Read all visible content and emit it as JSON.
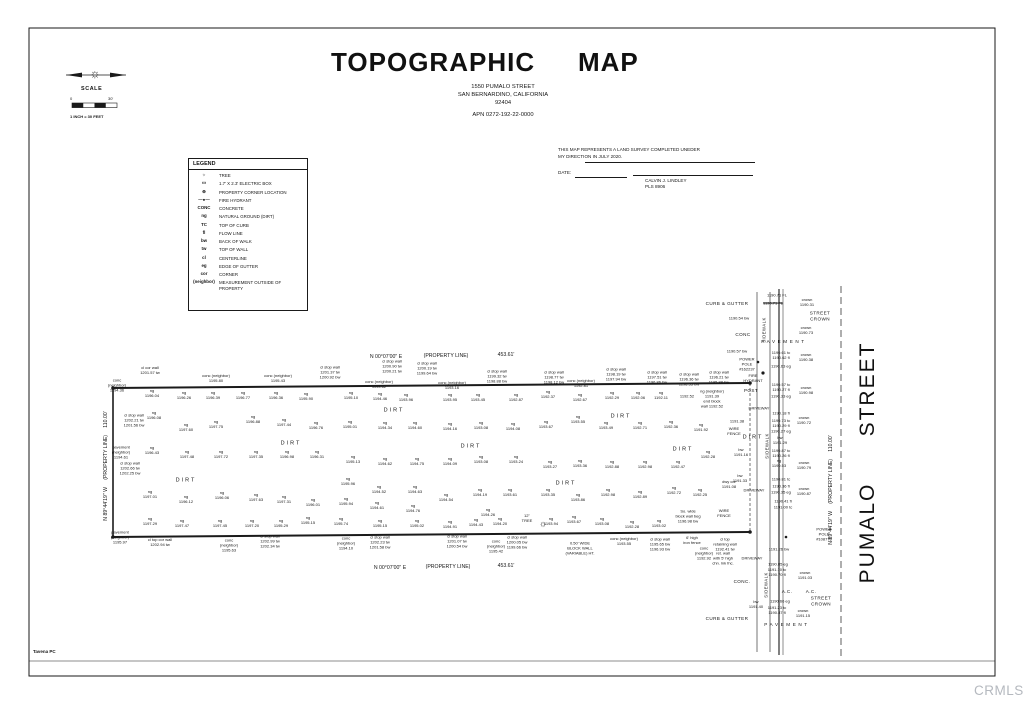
{
  "meta": {
    "watermark": "CRMLS",
    "credit": "Tavena PC"
  },
  "header": {
    "title_word1": "TOPOGRAPHIC",
    "title_word2": "MAP",
    "address_line1": "1550  PUMALO STREET",
    "address_line2": "SAN BERNARDINO, CALIFORNIA",
    "address_line3": "92404",
    "apn": "APN  0272-192-22-0000"
  },
  "scale": {
    "label": "SCALE",
    "start": "0",
    "end": "30'",
    "note": "1 INCH = 30 FEET"
  },
  "legend": {
    "title": "LEGEND",
    "items": [
      {
        "s": "☼",
        "d": "TREE"
      },
      {
        "s": "▭",
        "d": "1.7' X 2.3' ELECTRIC BOX"
      },
      {
        "s": "⊕",
        "d": "PROPERTY CORNER LOCATION"
      },
      {
        "s": "—●—",
        "d": "FIRE HYDRANT"
      },
      {
        "s": "CONC",
        "d": "CONCRETE"
      },
      {
        "s": "ng",
        "d": "NATURAL GROUND (DIRT)"
      },
      {
        "s": "TC",
        "d": "TOP OF CURB"
      },
      {
        "s": "fl",
        "d": "FLOW LINE"
      },
      {
        "s": "bw",
        "d": "BACK OF WALK"
      },
      {
        "s": "tw",
        "d": "TOP OF WALL"
      },
      {
        "s": "cl",
        "d": "CENTERLINE"
      },
      {
        "s": "eg",
        "d": "EDGE OF GUTTER"
      },
      {
        "s": "cor",
        "d": "CORNER"
      },
      {
        "s": "(neighbor)",
        "d": "MEASUREMENT OUTSIDE OF PROPERTY"
      }
    ]
  },
  "certification": {
    "line1": "THIS MAP REPRESENTS A LAND SURVEY COMPLETED UNEDER",
    "line2": "MY DIRECTION IN JULY 2020.",
    "date_label": "DATE:",
    "surveyor": "CALVIN J. LINDLEY",
    "license": "PLS 8906"
  },
  "map": {
    "street_name": "PUMALO STREET",
    "annotations": [
      [
        386,
        357,
        "N 00°07'00\" E",
        "br"
      ],
      [
        446,
        356,
        "(PROPERTY LINE)",
        "br"
      ],
      [
        506,
        355,
        "453.61'",
        "br"
      ],
      [
        390,
        568,
        "N 00°07'00\" E",
        "br"
      ],
      [
        448,
        567,
        "(PROPERTY LINE)",
        "br"
      ],
      [
        506,
        566,
        "453.61'",
        "br"
      ],
      [
        106,
        466,
        "N 89°44'19\" W     (PROPERTY LINE)     110.00'",
        "br",
        -90
      ],
      [
        831,
        490,
        "N 89°44'19\" W     (PROPERTY LINE)     110.00'",
        "br",
        -90
      ],
      [
        868,
        389,
        "STREET",
        "bigst",
        -90,
        "street-name"
      ],
      [
        868,
        533,
        "PUMALO",
        "bigst",
        -90,
        "street-name"
      ],
      [
        95,
        74,
        "☼",
        "compass-star",
        0,
        "compass-star-icon"
      ],
      [
        543,
        524,
        "☼",
        "tree",
        0,
        "tree-icon"
      ],
      [
        150,
        371,
        "cl cor wall\n1201.57 tw",
        "wl"
      ],
      [
        216,
        379,
        "conc (neighbor)\n1195.80",
        "wl"
      ],
      [
        278,
        379,
        "conc (neighbor)\n1195.43",
        "wl"
      ],
      [
        330,
        373,
        "cl stop wall\n1201.37 tw\n1200.92 bw",
        "wl"
      ],
      [
        392,
        367,
        "cl stop wall\n1200.90 tw\n1200.21 tw",
        "wl"
      ],
      [
        427,
        369,
        "cl stop wall\n1200.19 tw\n1199.64 bw",
        "wl"
      ],
      [
        379,
        385,
        "conc (neighbor)\n1193.62",
        "wl"
      ],
      [
        452,
        386,
        "conc (neighbor)\n1193.16",
        "wl"
      ],
      [
        497,
        377,
        "cl stop wall\n1199.32 tw\n1198.88 bw",
        "wl"
      ],
      [
        554,
        378,
        "cl stop wall\n1198.77 tw\n1198.12 bw",
        "wl"
      ],
      [
        581,
        384,
        "conc (neighbor)\n1192.81",
        "wl"
      ],
      [
        616,
        375,
        "cl stop wall\n1198.19 tw\n1197.94 bw",
        "wl"
      ],
      [
        657,
        378,
        "cl stop wall\n1197.51 tw\n1196.86 bw",
        "wl"
      ],
      [
        689,
        380,
        "cl stop wall\n1196.36 tw\n1196.33 bw",
        "wl"
      ],
      [
        719,
        378,
        "cl stop wall\n1196.21 tw\n1195.88 bw",
        "wl"
      ],
      [
        117,
        386,
        "conc\n(neighbor)\n1194.36",
        "wl"
      ],
      [
        134,
        421,
        "cl stop wall\n1202.21 tw\n1201.56 bw",
        "wl"
      ],
      [
        121,
        453,
        "pavement\n(neighbor)\n1194.61",
        "wl"
      ],
      [
        130,
        469,
        "cl stop wall\n1202.66 tw\n1202.25 bw",
        "wl"
      ],
      [
        120,
        538,
        "pavement\n(neighbor)\n1195.97",
        "wl"
      ],
      [
        160,
        543,
        "cl top cor wall\n1202.94 tw",
        "wl"
      ],
      [
        229,
        546,
        "conc\n(neighbor)\n1195.63",
        "wl"
      ],
      [
        270,
        542,
        "cl stop wall\n1202.99 tw\n1202.34 tw",
        "wl"
      ],
      [
        346,
        544,
        "conc\n(neighbor)\n1194.10",
        "wl"
      ],
      [
        380,
        543,
        "cl stop wall\n1202.23 tw\n1201.58 bw",
        "wl"
      ],
      [
        457,
        542,
        "cl stop wall\n1201.07 tw\n1200.54 bw",
        "wl"
      ],
      [
        496,
        547,
        "conc\n(neighbor)\n1195.42",
        "wl"
      ],
      [
        517,
        543,
        "cl stop wall\n1200.05 bw\n1199.66 bw",
        "wl"
      ],
      [
        527,
        519,
        "12\"\nTREE",
        "wl"
      ],
      [
        580,
        549,
        "0.50' WIDE\nBLOCK WALL\n(VARIABLE) HT.",
        "wl"
      ],
      [
        624,
        542,
        "conc (neighbor)\n1193.55",
        "wl"
      ],
      [
        660,
        545,
        "cl stop wall\n1195.65 bw\n1196.93 bw",
        "wl"
      ],
      [
        688,
        517,
        "So. wide\nblock wall beg\n1196.98 bw",
        "wl"
      ],
      [
        692,
        541,
        "6' high\niron fence",
        "wl"
      ],
      [
        704,
        554,
        "conc\n(neighbor)\n1192.92",
        "wl"
      ],
      [
        725,
        545,
        "cl top\nretaining wall\n1192.41 tw",
        "wl"
      ],
      [
        723,
        559,
        "ret. wall\nwith 5' high\nchn. lnk fnc.",
        "wl"
      ],
      [
        152,
        394,
        "ng\n1196.04"
      ],
      [
        184,
        396,
        "ng\n1196.26"
      ],
      [
        213,
        396,
        "ng\n1196.39"
      ],
      [
        243,
        396,
        "ng\n1196.77"
      ],
      [
        276,
        396,
        "ng\n1196.36"
      ],
      [
        306,
        397,
        "ng\n1195.90"
      ],
      [
        351,
        396,
        "ng\n1195.10"
      ],
      [
        380,
        397,
        "ng\n1194.46"
      ],
      [
        406,
        398,
        "ng\n1193.96"
      ],
      [
        450,
        398,
        "ng\n1193.95"
      ],
      [
        478,
        398,
        "ng\n1193.45"
      ],
      [
        516,
        398,
        "ng\n1192.87"
      ],
      [
        548,
        395,
        "ng\n1192.37"
      ],
      [
        580,
        398,
        "ng\n1192.67"
      ],
      [
        612,
        396,
        "ng\n1192.29"
      ],
      [
        638,
        396,
        "ng\n1192.06"
      ],
      [
        661,
        396,
        "ng\n1192.11"
      ],
      [
        687,
        397,
        "1192.52"
      ],
      [
        154,
        416,
        "ng\n1196.08"
      ],
      [
        186,
        428,
        "ng\n1197.60"
      ],
      [
        216,
        425,
        "ng\n1197.75"
      ],
      [
        253,
        420,
        "ng\n1196.88"
      ],
      [
        284,
        423,
        "ng\n1197.44"
      ],
      [
        316,
        426,
        "ng\n1196.76"
      ],
      [
        350,
        425,
        "ng\n1195.01"
      ],
      [
        385,
        426,
        "ng\n1194.34"
      ],
      [
        415,
        426,
        "ng\n1194.60"
      ],
      [
        450,
        427,
        "ng\n1194.16"
      ],
      [
        481,
        426,
        "ng\n1193.08"
      ],
      [
        513,
        427,
        "ng\n1194.08"
      ],
      [
        546,
        425,
        "ng\n1193.67"
      ],
      [
        578,
        420,
        "ng\n1193.55"
      ],
      [
        606,
        426,
        "ng\n1193.49"
      ],
      [
        640,
        426,
        "ng\n1192.71"
      ],
      [
        671,
        425,
        "ng\n1192.36"
      ],
      [
        701,
        428,
        "ng\n1191.92"
      ],
      [
        152,
        451,
        "ng\n1196.43"
      ],
      [
        187,
        455,
        "ng\n1197.48"
      ],
      [
        221,
        455,
        "ng\n1197.72"
      ],
      [
        256,
        455,
        "ng\n1197.35"
      ],
      [
        287,
        455,
        "ng\n1196.98"
      ],
      [
        317,
        455,
        "ng\n1196.31"
      ],
      [
        353,
        460,
        "ng\n1195.13"
      ],
      [
        385,
        462,
        "ng\n1194.62"
      ],
      [
        417,
        462,
        "ng\n1194.75"
      ],
      [
        450,
        462,
        "ng\n1194.09"
      ],
      [
        481,
        460,
        "ng\n1193.08"
      ],
      [
        516,
        460,
        "ng\n1193.24"
      ],
      [
        550,
        465,
        "ng\n1193.27"
      ],
      [
        580,
        464,
        "ng\n1193.36"
      ],
      [
        612,
        465,
        "ng\n1192.88"
      ],
      [
        645,
        465,
        "ng\n1192.98"
      ],
      [
        678,
        465,
        "ng\n1192.47"
      ],
      [
        708,
        455,
        "ng\n1192.28"
      ],
      [
        150,
        495,
        "ng\n1197.01"
      ],
      [
        186,
        500,
        "ng\n1196.12"
      ],
      [
        222,
        496,
        "ng\n1196.06"
      ],
      [
        256,
        498,
        "ng\n1197.63"
      ],
      [
        284,
        500,
        "ng\n1197.31"
      ],
      [
        313,
        503,
        "ng\n1196.01"
      ],
      [
        348,
        482,
        "ng\n1195.96"
      ],
      [
        379,
        490,
        "ng\n1194.52"
      ],
      [
        415,
        490,
        "ng\n1194.63"
      ],
      [
        446,
        498,
        "ng\n1194.54"
      ],
      [
        480,
        493,
        "ng\n1194.19"
      ],
      [
        510,
        493,
        "ng\n1193.61"
      ],
      [
        548,
        493,
        "ng\n1193.35"
      ],
      [
        578,
        498,
        "ng\n1193.86"
      ],
      [
        608,
        493,
        "ng\n1192.98"
      ],
      [
        640,
        495,
        "ng\n1192.89"
      ],
      [
        674,
        491,
        "ng\n1192.72"
      ],
      [
        700,
        493,
        "ng\n1192.25"
      ],
      [
        346,
        502,
        "ng\n1195.94"
      ],
      [
        377,
        506,
        "ng\n1194.61"
      ],
      [
        413,
        509,
        "ng\n1194.76"
      ],
      [
        488,
        513,
        "ng\n1194.26"
      ],
      [
        150,
        522,
        "ng\n1197.29"
      ],
      [
        182,
        524,
        "ng\n1197.47"
      ],
      [
        220,
        524,
        "ng\n1197.45"
      ],
      [
        252,
        524,
        "ng\n1197.20"
      ],
      [
        281,
        524,
        "ng\n1195.29"
      ],
      [
        308,
        521,
        "ng\n1195.15"
      ],
      [
        341,
        522,
        "ng\n1195.74"
      ],
      [
        380,
        524,
        "ng\n1195.15"
      ],
      [
        417,
        524,
        "ng\n1195.02"
      ],
      [
        450,
        525,
        "ng\n1194.91"
      ],
      [
        476,
        523,
        "ng\n1194.43"
      ],
      [
        500,
        522,
        "ng\n1194.20"
      ],
      [
        551,
        522,
        "ng\n1193.94"
      ],
      [
        574,
        520,
        "ng\n1193.67"
      ],
      [
        602,
        522,
        "ng\n1193.08"
      ],
      [
        632,
        525,
        "ng\n1192.28"
      ],
      [
        659,
        524,
        "ng\n1193.02"
      ],
      [
        186,
        481,
        "DIRT",
        "ar"
      ],
      [
        291,
        444,
        "DIRT",
        "ar"
      ],
      [
        394,
        411,
        "DIRT",
        "ar"
      ],
      [
        471,
        447,
        "DIRT",
        "ar"
      ],
      [
        566,
        484,
        "DIRT",
        "ar"
      ],
      [
        621,
        417,
        "DIRT",
        "ar"
      ],
      [
        683,
        450,
        "DIRT",
        "ar"
      ],
      [
        753,
        438,
        "DIRT",
        "ar"
      ],
      [
        727,
        304,
        "CURB & GUTTER",
        "st"
      ],
      [
        777,
        296,
        "1190.71 FL"
      ],
      [
        773,
        304,
        "1190.71 FL",
        "pt strike"
      ],
      [
        807,
        303,
        "crown\n1190.31"
      ],
      [
        820,
        316,
        "STREET\nCROWN",
        "st"
      ],
      [
        806,
        331,
        "crown\n1190.73"
      ],
      [
        784,
        342,
        "PAVEMENT",
        "pv"
      ],
      [
        743,
        335,
        "CONC",
        "st"
      ],
      [
        739,
        319,
        "1190.54 bw"
      ],
      [
        737,
        352,
        "1190.57 bw"
      ],
      [
        781,
        356,
        "1190.61 tc\n1190.62 fl"
      ],
      [
        806,
        358,
        "crown\n1190.38"
      ],
      [
        781,
        367,
        "1190.63 eg"
      ],
      [
        747,
        365,
        "POWER\nPOLE\n#162237",
        "wl"
      ],
      [
        753,
        379,
        "FIRE\nHYDRANT",
        "wl"
      ],
      [
        751,
        391,
        "POST",
        "st"
      ],
      [
        781,
        388,
        "1190.57 tc\n1190.27 fl"
      ],
      [
        806,
        391,
        "crown\n1190.98"
      ],
      [
        781,
        397,
        "1190.33 eg"
      ],
      [
        759,
        409,
        "DRIVEWAY",
        "pt"
      ],
      [
        781,
        414,
        "1190.18 fl"
      ],
      [
        781,
        424,
        "1190.73 tc\n1190.29 fl"
      ],
      [
        781,
        432,
        "1190.27 eg"
      ],
      [
        780,
        441,
        "bw\n1191.29"
      ],
      [
        804,
        421,
        "crown\n1190.72"
      ],
      [
        764,
        330,
        "SIDEWALK",
        "v",
        -90
      ],
      [
        767,
        446,
        "SIDEWALK",
        "v",
        -90
      ],
      [
        766,
        585,
        "SIDEWALK",
        "v",
        -90
      ],
      [
        781,
        454,
        "1190.87 tc\n1190.26 fl"
      ],
      [
        779,
        464,
        "ng\n1190.53"
      ],
      [
        804,
        466,
        "crown\n1190.79"
      ],
      [
        741,
        453,
        "bw\n1191.16"
      ],
      [
        740,
        479,
        "bw\n1191.33"
      ],
      [
        781,
        480,
        "1190.81 tc"
      ],
      [
        781,
        487,
        "1190.36 fl"
      ],
      [
        781,
        493,
        "1190.35 eg"
      ],
      [
        804,
        492,
        "crown\n1190.87"
      ],
      [
        754,
        491,
        "DRIVEWAY",
        "pt"
      ],
      [
        783,
        502,
        "1190.41 fl"
      ],
      [
        783,
        508,
        "1191.00 tc"
      ],
      [
        712,
        399,
        "ng (neighbor)\n1191.39\nend block\nwall 1192.52",
        "wl"
      ],
      [
        737,
        422,
        "1191.38"
      ],
      [
        734,
        432,
        "WIRE\nFENCE",
        "wl"
      ],
      [
        724,
        514,
        "WIRE\nFENCE",
        "wl"
      ],
      [
        729,
        485,
        "dwy cor\n1191.08"
      ],
      [
        824,
        535,
        "POWER\nPOLE\n#108776",
        "wl"
      ],
      [
        752,
        559,
        "DRIVEWAY",
        "pt"
      ],
      [
        779,
        550,
        "1191.26 bw"
      ],
      [
        778,
        565,
        "1190.85 eg"
      ],
      [
        777,
        573,
        "1191.10 tc\n1190.70 fl"
      ],
      [
        742,
        582,
        "CONC.",
        "st"
      ],
      [
        805,
        576,
        "crown\n1191.03"
      ],
      [
        787,
        592,
        "A.C.",
        "st"
      ],
      [
        811,
        592,
        "A.C.",
        "st"
      ],
      [
        780,
        602,
        "1190.66 eg"
      ],
      [
        821,
        601,
        "STREET\nCROWN",
        "st"
      ],
      [
        756,
        605,
        "bw\n1191.40"
      ],
      [
        777,
        611,
        "1191.23 tc\n1190.87 fl"
      ],
      [
        727,
        619,
        "CURB & GUTTER",
        "st"
      ],
      [
        803,
        614,
        "crown\n1191.15"
      ],
      [
        787,
        625,
        "PAVEMENT",
        "pv"
      ]
    ]
  }
}
